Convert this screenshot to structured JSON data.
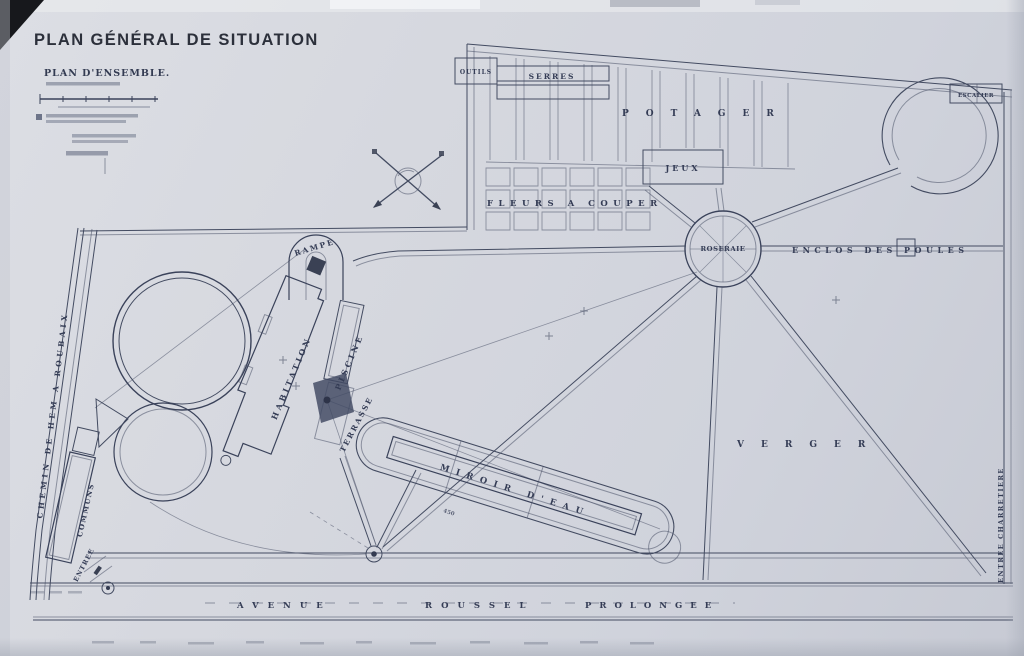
{
  "title_block": {
    "title": "PLAN GÉNÉRAL DE SITUATION",
    "subtitle": "PLAN D'ENSEMBLE."
  },
  "areas": {
    "potager": "POTAGER",
    "serres": "SERRES",
    "outils": "OUTILS",
    "jeux": "JEUX",
    "fleurs_a_couper": "FLEURS A COUPER",
    "roseraie": "ROSERAIE",
    "enclos_des_poules": "ENCLOS DES POULES",
    "verger": "VERGER"
  },
  "house": {
    "habitation": "HABITATION",
    "piscine": "PISCINE",
    "terrasse": "TERRASSE",
    "rampe": "RAMPE",
    "miroir_d_eau": "MIROIR D'EAU",
    "communs": "COMMUNS"
  },
  "roads": {
    "chemin": "CHEMIN DE HEM A ROUBAIX",
    "avenue": [
      "AVENUE",
      "ROUSSEL",
      "PROLONGEE"
    ]
  },
  "entries": {
    "entree": "ENTREE",
    "entree_charretiere": "ENTREE CHARRETIERE",
    "escalier": "ESCALIER"
  },
  "annotations": {
    "miroir_dim": "450"
  }
}
